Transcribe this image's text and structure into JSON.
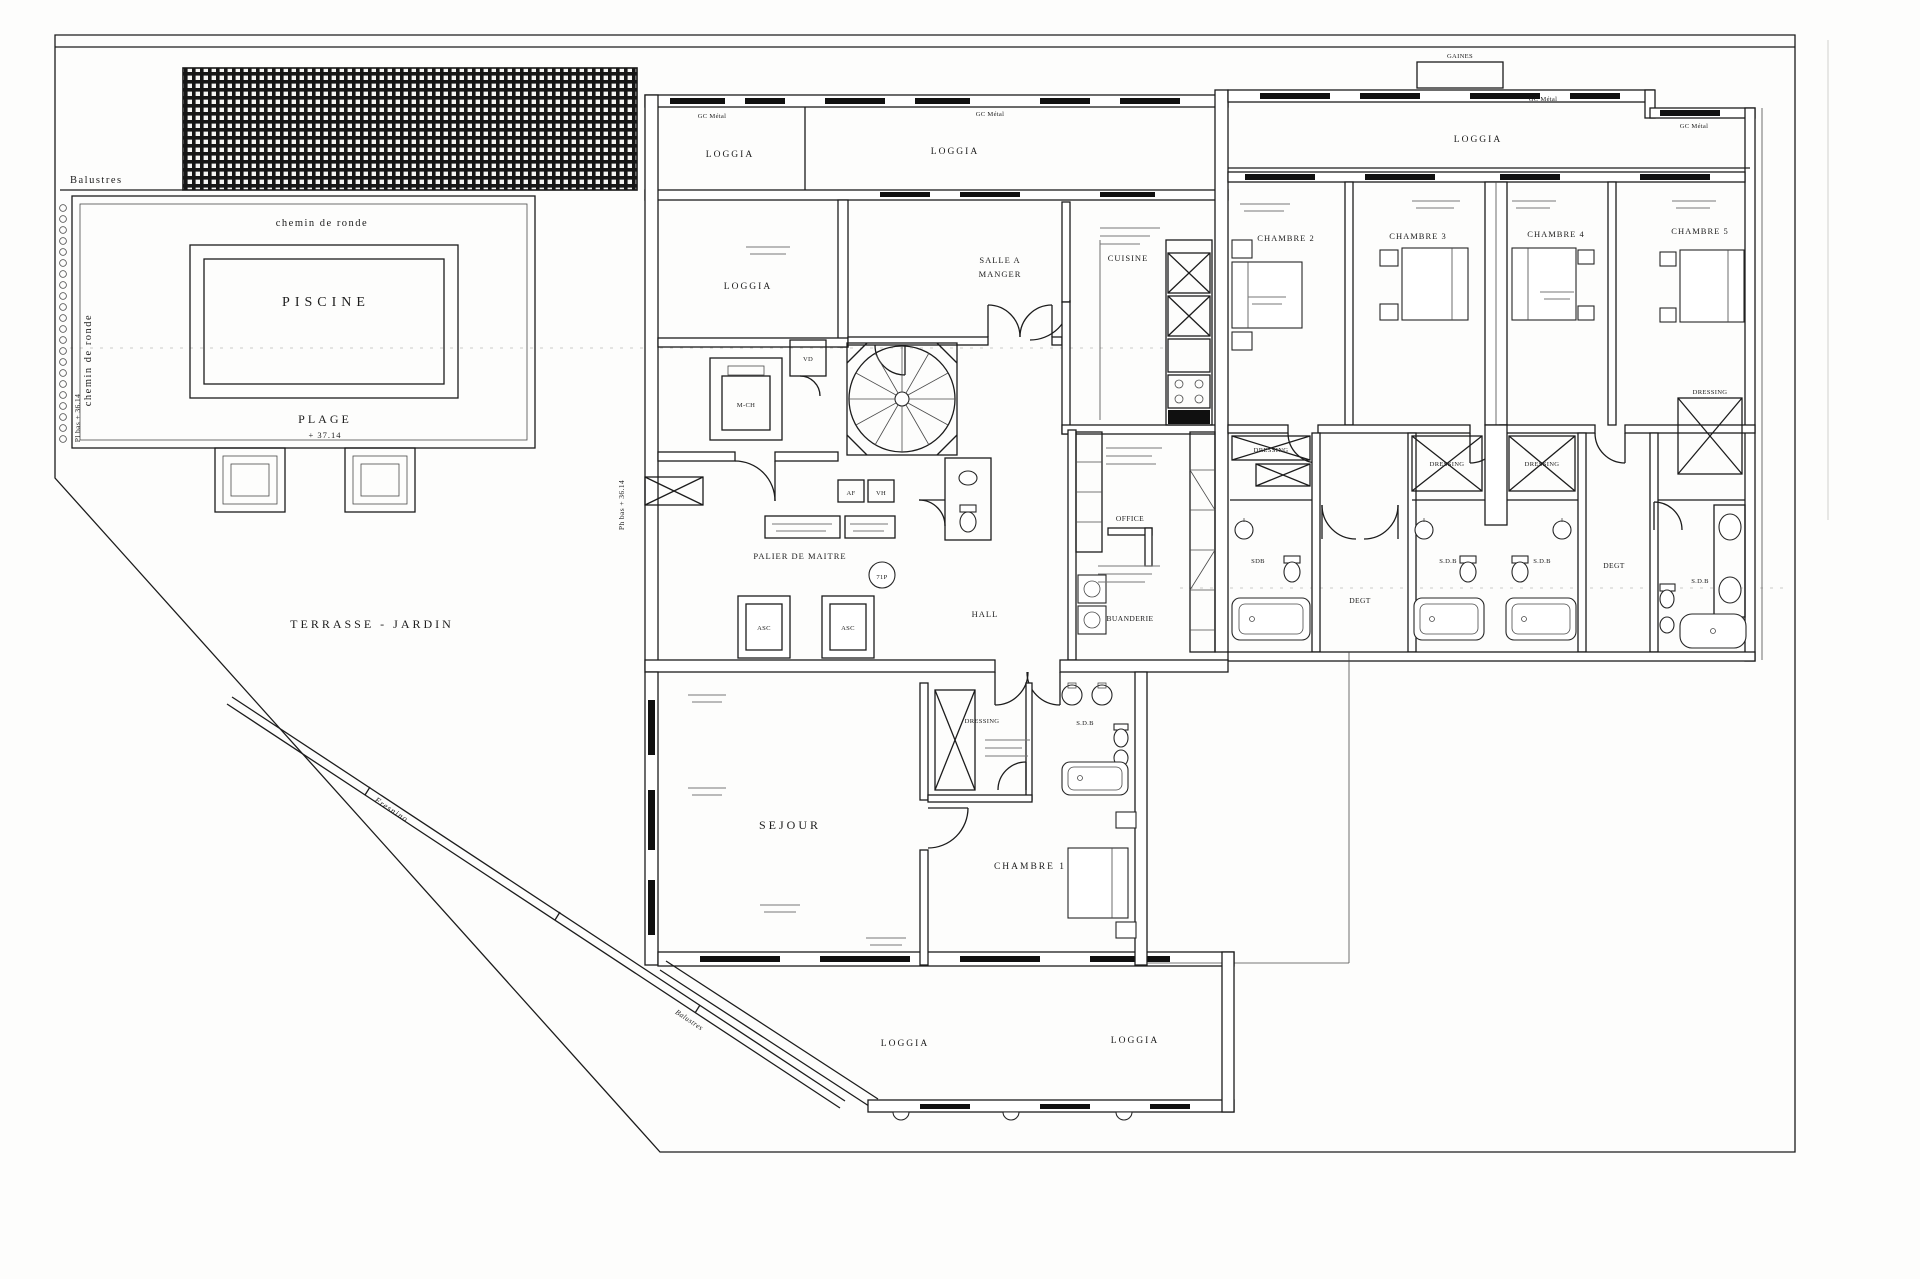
{
  "labels": {
    "balustres": "Balustres",
    "chemin_de_ronde": "chemin de ronde",
    "piscine": "PISCINE",
    "plage": "PLAGE",
    "plage_level": "+ 37.14",
    "pl_bas_level": "Pl bas + 36.14",
    "ph_bas_level": "Ph bas + 36.14",
    "terrasse_jardin": "TERRASSE - JARDIN",
    "fresnino": "Fresnino",
    "gaines": "GAINES",
    "gc_metal": "GC Métal",
    "loggia": "LOGGIA",
    "salle_a_manger_line1": "SALLE A",
    "salle_a_manger_line2": "MANGER",
    "cuisine": "CUISINE",
    "office": "OFFICE",
    "hall": "HALL",
    "buanderie": "BUANDERIE",
    "palier_de_maitre": "PALIER DE MAITRE",
    "sejour": "SEJOUR",
    "chambre_1": "CHAMBRE 1",
    "chambre_2": "CHAMBRE 2",
    "chambre_3": "CHAMBRE 3",
    "chambre_4": "CHAMBRE 4",
    "chambre_5": "CHAMBRE 5",
    "dressing": "DRESSING",
    "sdb_plain": "SDB",
    "sdb": "S.D.B",
    "degt": "DEGT",
    "vd": "VD",
    "m_ch": "M-CH",
    "asc": "ASC",
    "af": "AF",
    "vh": "VH",
    "stair_tag": "71P"
  }
}
